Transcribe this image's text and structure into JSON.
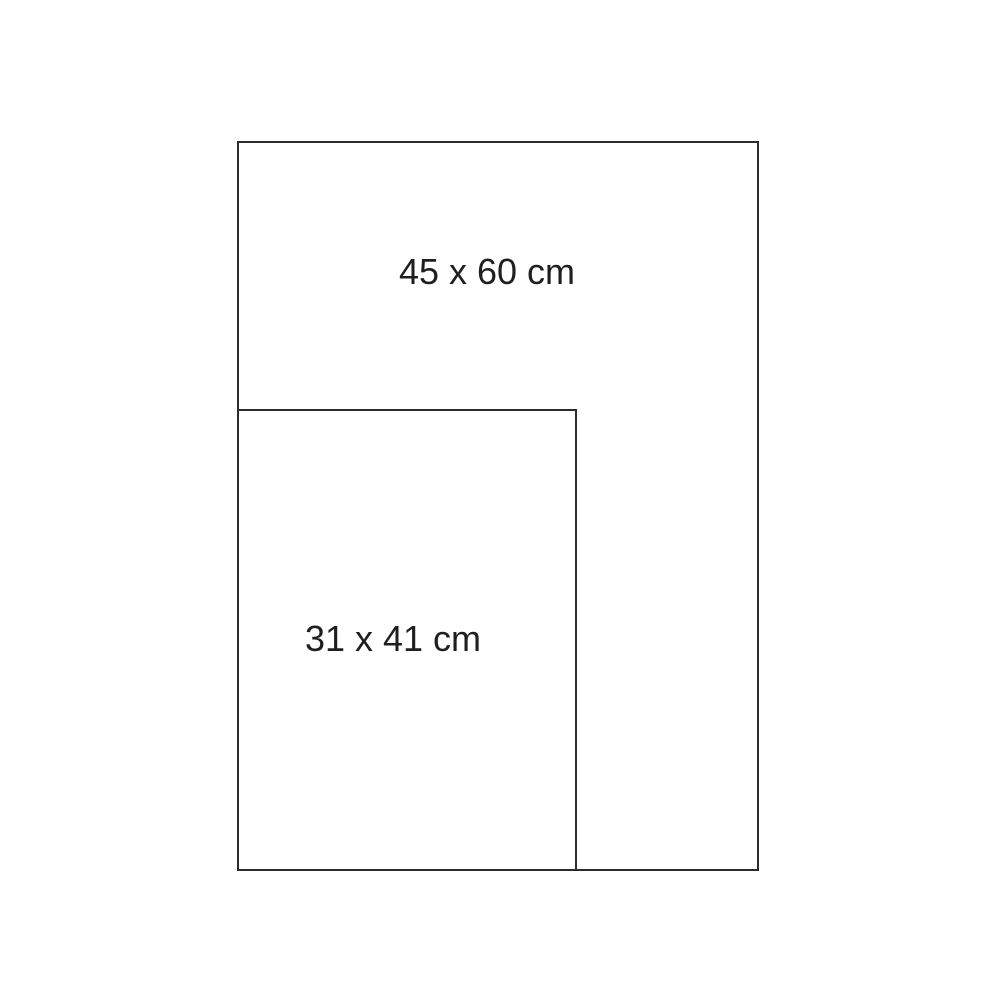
{
  "colors": {
    "background": "#ffffff",
    "border_color": "#2b2b2b",
    "text_color": "#1f1f1f"
  },
  "diagram": {
    "type": "size-comparison",
    "rectangles": [
      {
        "name": "large",
        "label": "45 x 60 cm",
        "width_cm": 45,
        "height_cm": 60
      },
      {
        "name": "small",
        "label": "31 x 41 cm",
        "width_cm": 31,
        "height_cm": 41
      }
    ]
  }
}
